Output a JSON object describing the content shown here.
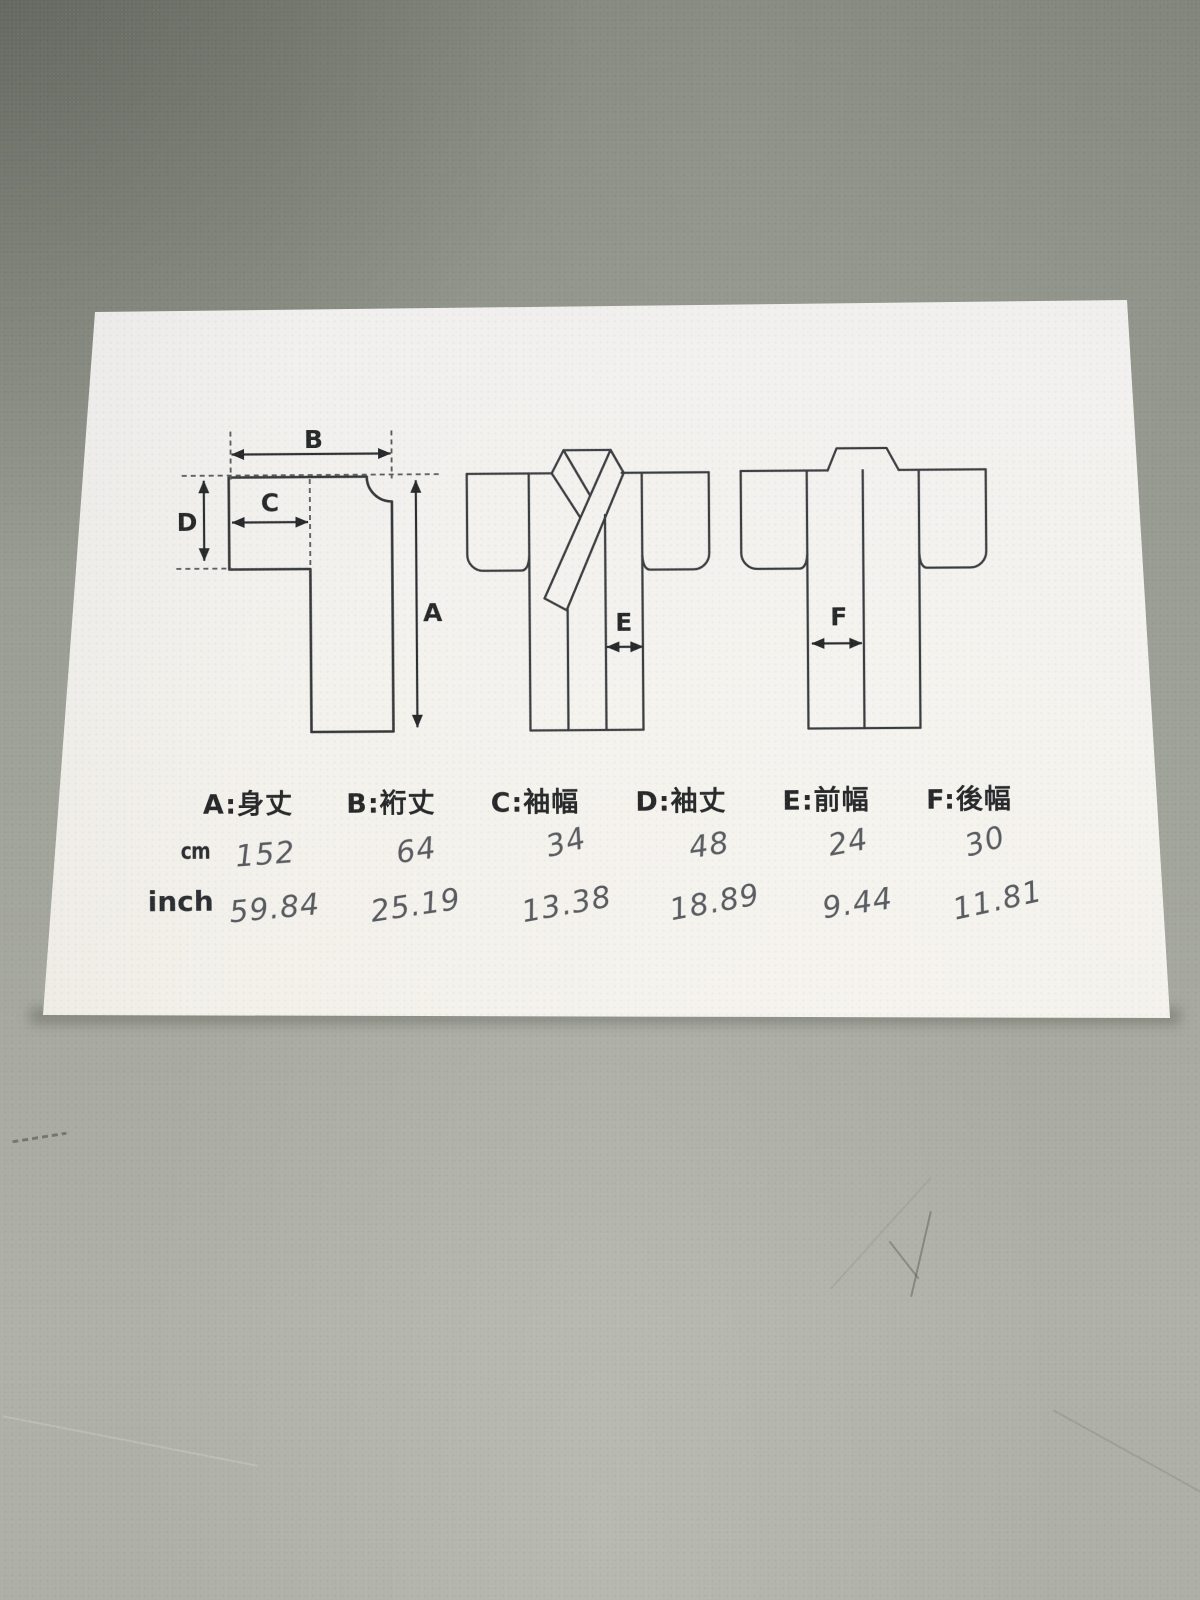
{
  "sheet": {
    "legend": [
      "A:身丈",
      "B:裄丈",
      "C:袖幅",
      "D:袖丈",
      "E:前幅",
      "F:後幅"
    ],
    "diagram_labels": [
      "A",
      "B",
      "C",
      "D",
      "E",
      "F"
    ],
    "unit_rows": [
      {
        "label": "cm",
        "values": [
          "152",
          "64",
          "34",
          "48",
          "24",
          "30"
        ]
      },
      {
        "label": "inch",
        "values": [
          "59.84",
          "25.19",
          "13.38",
          "18.89",
          "9.44",
          "11.81"
        ]
      }
    ],
    "colors": {
      "ink": "#2b2e31",
      "pen": "#41464c",
      "paper": "#f2f0ea",
      "table": "#9a9d94"
    }
  }
}
